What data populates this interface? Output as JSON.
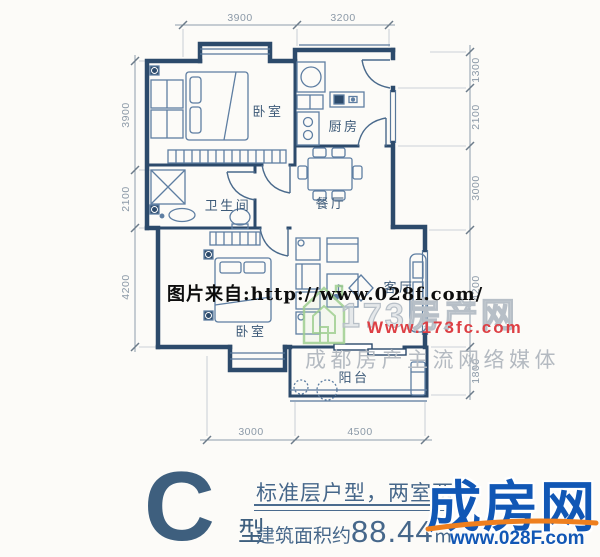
{
  "plan": {
    "room_labels": {
      "bedroom_top": "卧室",
      "kitchen": "厨房",
      "bathroom": "卫生间",
      "dining": "餐厅",
      "bedroom_bottom": "卧室",
      "living": "客厅",
      "balcony": "阳台"
    },
    "dims": {
      "top": [
        "3900",
        "3200"
      ],
      "left": [
        "3900",
        "2100",
        "4200"
      ],
      "right": [
        "1300",
        "2100",
        "3000",
        "4200",
        "1800"
      ],
      "bottom": [
        "3000",
        "4500"
      ]
    }
  },
  "watermarks": {
    "photo_source": "图片来自:http://www.028f.com/",
    "logo_173": {
      "name": "173房产网",
      "url": "Www.173fc.com",
      "tagline": "成都房产主流网络媒体"
    }
  },
  "caption": {
    "type_letter": "C",
    "type_suffix": "型",
    "line1": "标准层户型，两室两",
    "area_prefix": "建筑面积约",
    "area_value": "88.44",
    "area_unit": "㎡"
  },
  "brand": {
    "name": "成房网",
    "url": "www.028F.com"
  },
  "colors": {
    "wall": "#2c4a6b",
    "furniture": "#5e7ea2",
    "dim": "#8b99a7",
    "watermark_red": "#dd3f44",
    "watermark_green": "#9fcf90",
    "brand_blue": "#1157b5",
    "brand_orange": "#ee7f1e",
    "caption_blue": "#46678a"
  }
}
